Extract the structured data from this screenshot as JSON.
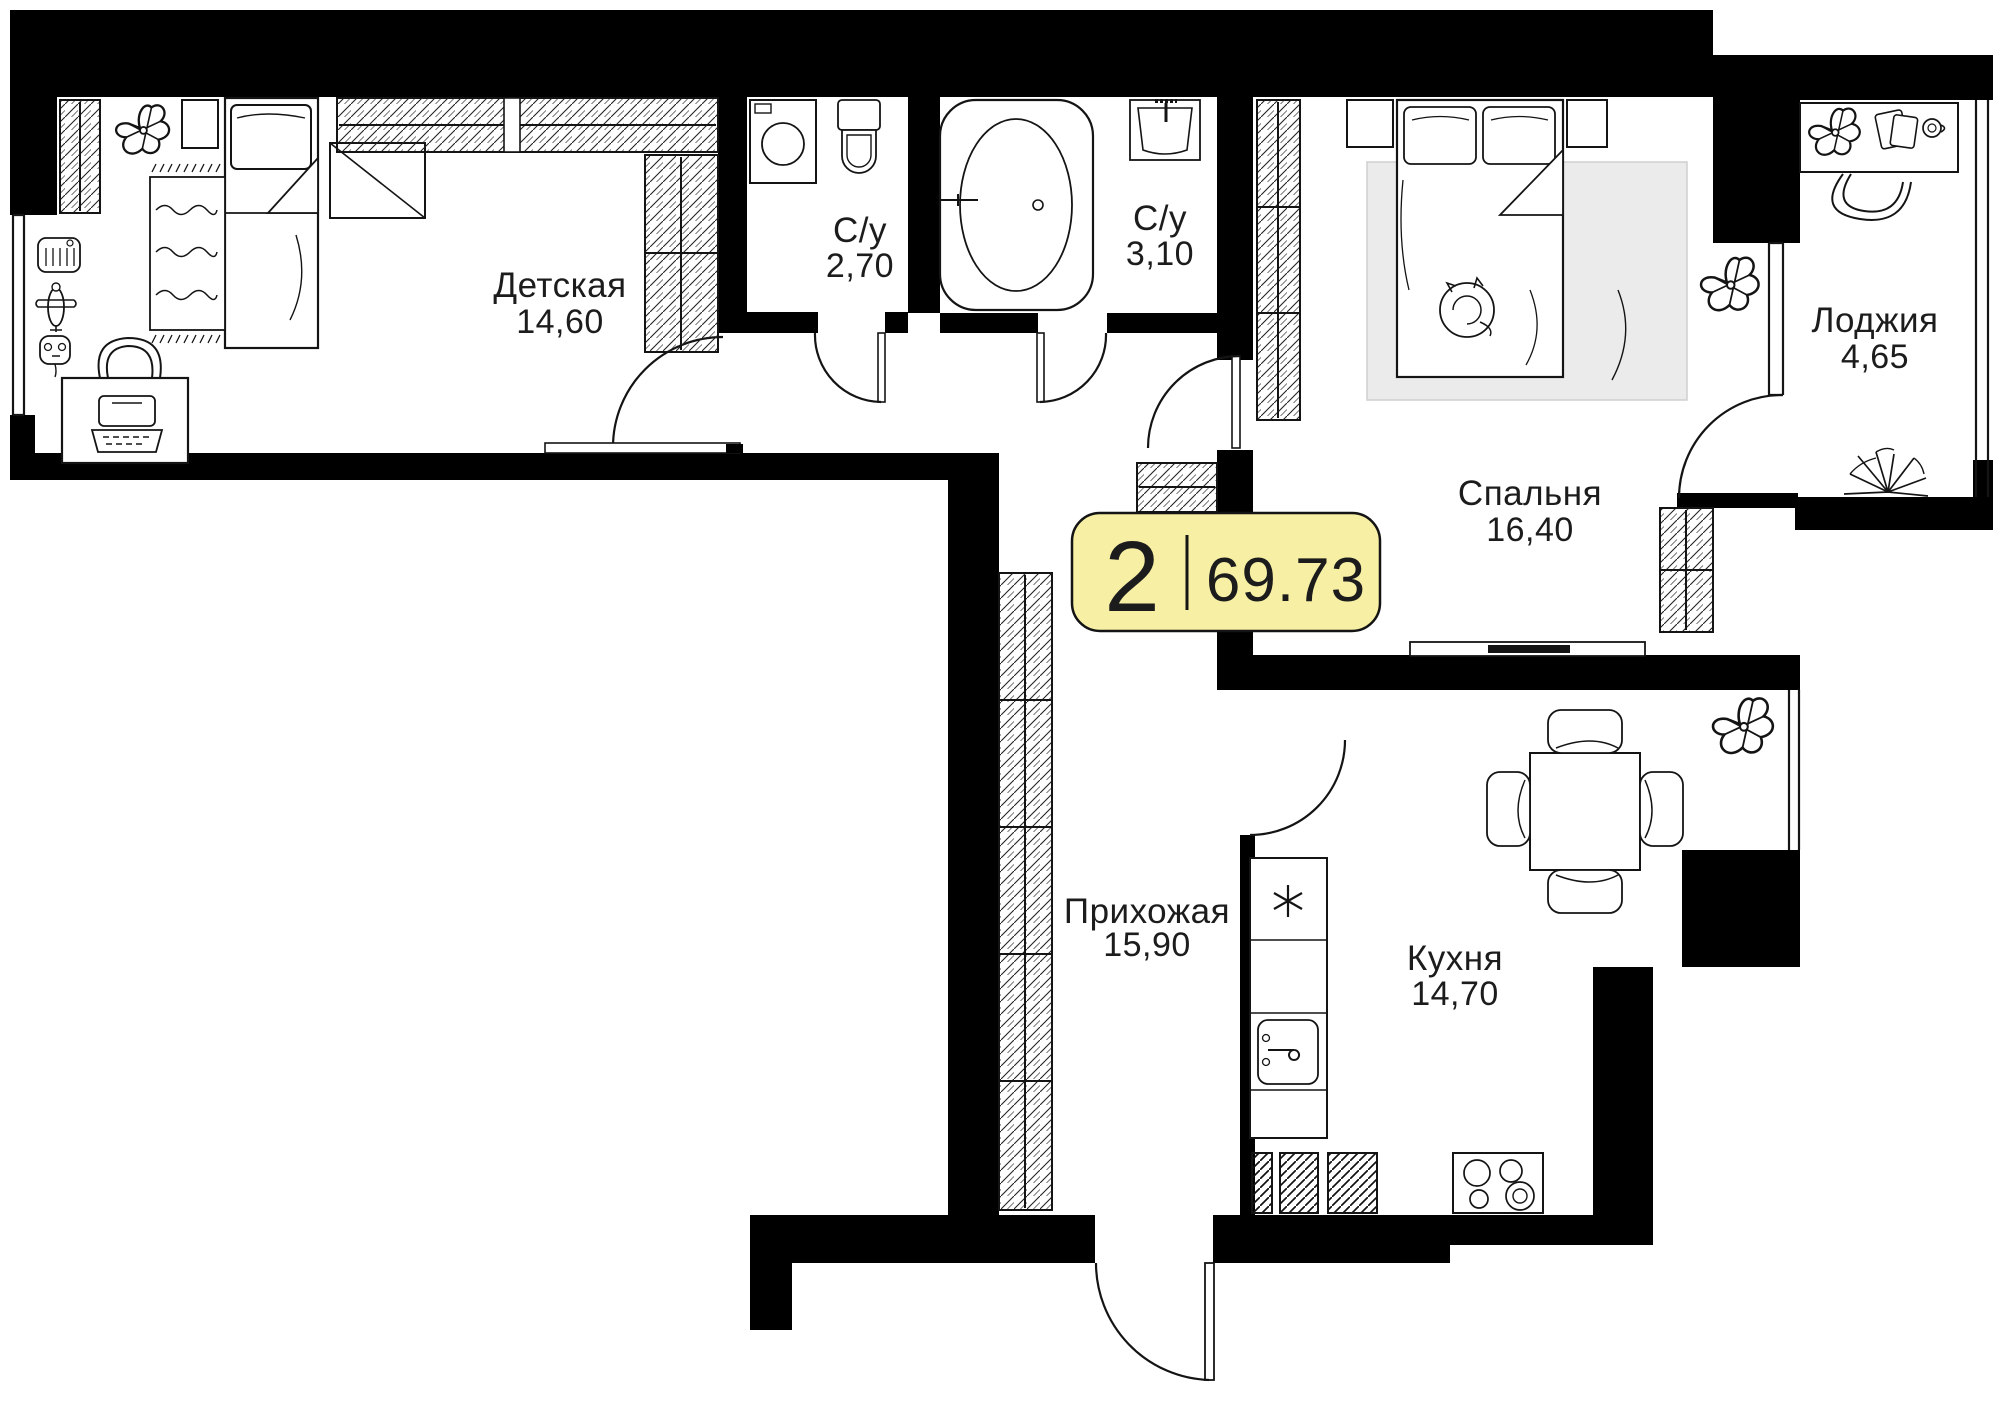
{
  "floorplan": {
    "badge": {
      "rooms_count": "2",
      "total_area": "69.73"
    },
    "rooms": [
      {
        "key": "detskaya",
        "name": "Детская",
        "area": "14,60"
      },
      {
        "key": "bathroom-1",
        "name": "С/у",
        "area": "2,70"
      },
      {
        "key": "bathroom-2",
        "name": "С/у",
        "area": "3,10"
      },
      {
        "key": "spalnya",
        "name": "Спальня",
        "area": "16,40"
      },
      {
        "key": "lodzhiya",
        "name": "Лоджия",
        "area": "4,65"
      },
      {
        "key": "prihozhaya",
        "name": "Прихожая",
        "area": "15,90"
      },
      {
        "key": "kuhnya",
        "name": "Кухня",
        "area": "14,70"
      }
    ],
    "colors": {
      "wall": "#000000",
      "background": "#ffffff",
      "badge_fill": "#F6EFA4",
      "badge_border": "#141414",
      "rug": "#EBEBEB"
    }
  }
}
